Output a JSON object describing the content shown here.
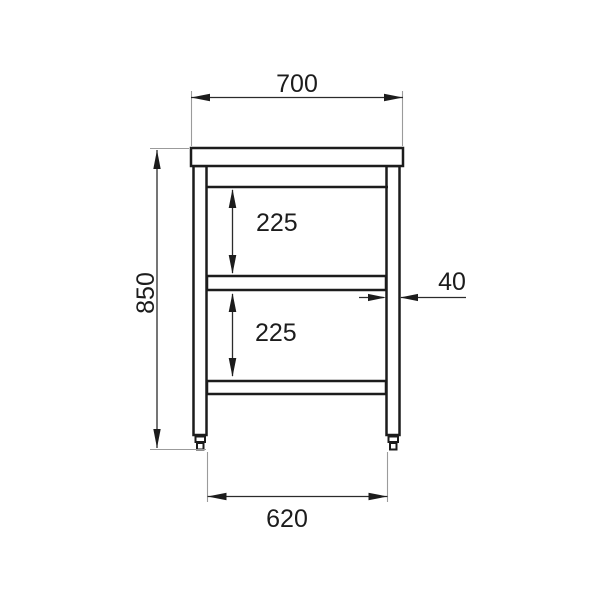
{
  "drawing": {
    "title": "worktable-front-elevation",
    "description": "Dimensioned technical line drawing (front view) of a worktable with a top, two legs on adjustable feet, and two under-shelves.",
    "colors": {
      "background": "#ffffff",
      "object_line": "#1c1c1c",
      "dimension_line": "#2b2b2b",
      "extension_line": "#9b9b9b",
      "text": "#1c1c1c"
    },
    "dimensions": {
      "top_width": "700",
      "overall_height": "850",
      "upper_shelf_spacing": "225",
      "lower_shelf_spacing": "225",
      "leg_width": "40",
      "base_width": "620"
    }
  }
}
